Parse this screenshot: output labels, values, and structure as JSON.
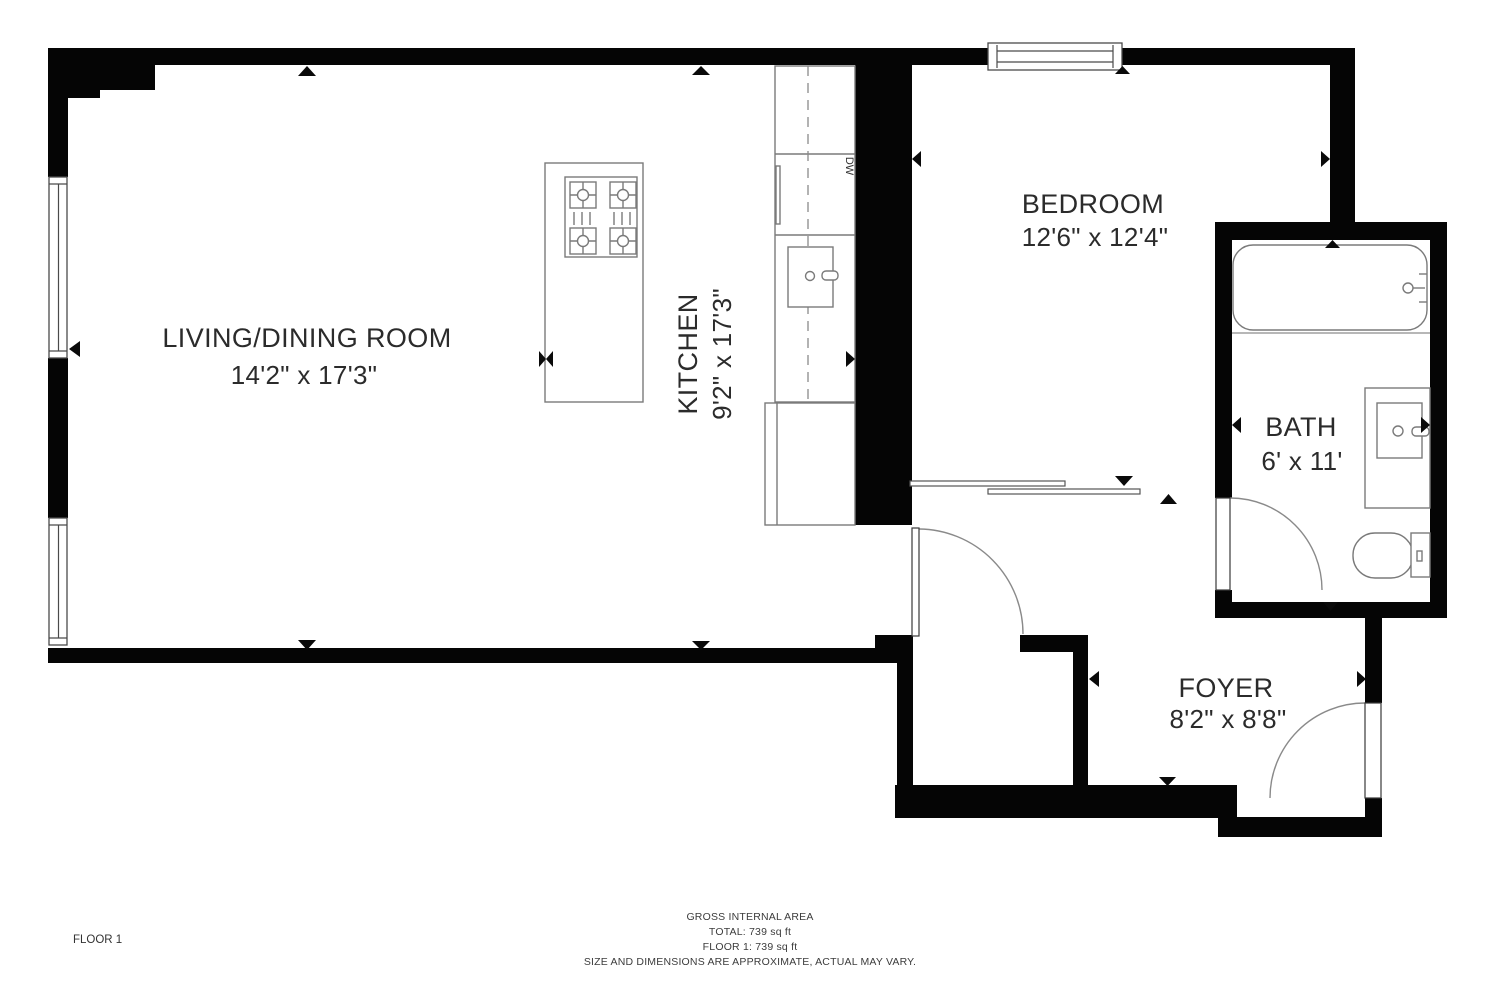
{
  "plan": {
    "rooms": {
      "living": {
        "name": "LIVING/DINING ROOM",
        "dims": "14'2\" x 17'3\""
      },
      "kitchen": {
        "name": "KITCHEN",
        "dims": "9'2\" x 17'3\""
      },
      "bedroom": {
        "name": "BEDROOM",
        "dims": "12'6\" x 12'4\""
      },
      "bath": {
        "name": "BATH",
        "dims": "6' x 11'"
      },
      "foyer": {
        "name": "FOYER",
        "dims": "8'2\" x 8'8\""
      }
    },
    "appliance_labels": {
      "dishwasher": "DW"
    },
    "floor_label": "FLOOR 1",
    "footer": {
      "title": "GROSS INTERNAL AREA",
      "total": "TOTAL: 739 sq ft",
      "floor1": "FLOOR 1: 739 sq ft",
      "disclaimer": "SIZE AND DIMENSIONS ARE APPROXIMATE, ACTUAL MAY VARY."
    },
    "colors": {
      "wall": "#050505",
      "fixture_stroke": "#7a7a7a",
      "label_text": "#2b2b2b"
    }
  }
}
